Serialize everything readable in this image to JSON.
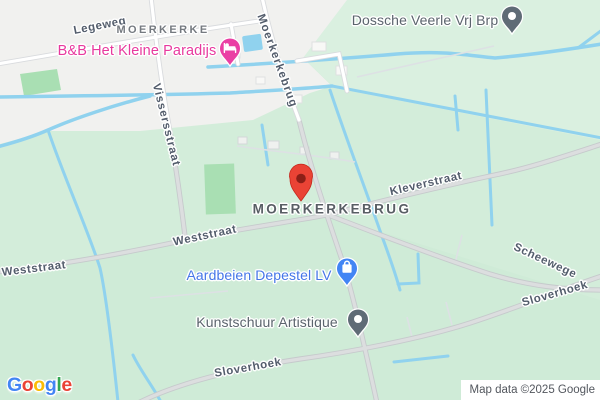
{
  "map": {
    "locality_labels": [
      {
        "text": "MOERKERKE"
      },
      {
        "text": "MOERKERKEBRUG"
      }
    ],
    "street_labels": [
      {
        "id": "legeweg",
        "text": "Legeweg"
      },
      {
        "id": "moerkerkebrug-street",
        "text": "Moerkerkebrug"
      },
      {
        "id": "vissersstraat",
        "text": "Vissersstraat"
      },
      {
        "id": "kleverstraat",
        "text": "Kleverstraat"
      },
      {
        "id": "weststraat-center",
        "text": "Weststraat"
      },
      {
        "id": "weststraat-left",
        "text": "Weststraat"
      },
      {
        "id": "scheewege",
        "text": "Scheewege"
      },
      {
        "id": "sloverhoek-east",
        "text": "Sloverhoek"
      },
      {
        "id": "sloverhoek-south",
        "text": "Sloverhoek"
      }
    ],
    "pois": [
      {
        "name": "B&B Het Kleine Paradijs",
        "category": "lodging",
        "icon": "bed-pin-icon",
        "label_color": "#e8399e",
        "pin_color": "#ea3fa4"
      },
      {
        "name": "Dossche Veerle Vrj Brp",
        "category": "place",
        "icon": "circle-pin-icon",
        "label_color": "#5b646d",
        "pin_color": "#5f6b76"
      },
      {
        "name": "Aardbeien Depestel LV",
        "category": "shopping",
        "icon": "shopping-bag-pin-icon",
        "label_color": "#4576e8",
        "pin_color": "#4285f4"
      },
      {
        "name": "Kunstschuur Artistique",
        "category": "place",
        "icon": "circle-pin-icon",
        "label_color": "#5b646d",
        "pin_color": "#5f6b76"
      }
    ],
    "marker": {
      "type": "red-location-marker",
      "color": "#ea4335",
      "inner_color": "#8c1f17"
    },
    "colors": {
      "field": "#d3edda",
      "urban": "#f1f1ef",
      "water": "#90d2ee",
      "park": "#a9dfb3",
      "road_fill": "#dcdedf",
      "road_casing": "#c6cacc",
      "street_label": "#535d6c",
      "locality_label": "#757a80"
    }
  },
  "footer": {
    "logo_letters": [
      {
        "ch": "G",
        "color": "#4285F4"
      },
      {
        "ch": "o",
        "color": "#EA4335"
      },
      {
        "ch": "o",
        "color": "#FBBC05"
      },
      {
        "ch": "g",
        "color": "#4285F4"
      },
      {
        "ch": "l",
        "color": "#34A853"
      },
      {
        "ch": "e",
        "color": "#EA4335"
      }
    ],
    "attribution": "Map data ©2025 Google"
  }
}
